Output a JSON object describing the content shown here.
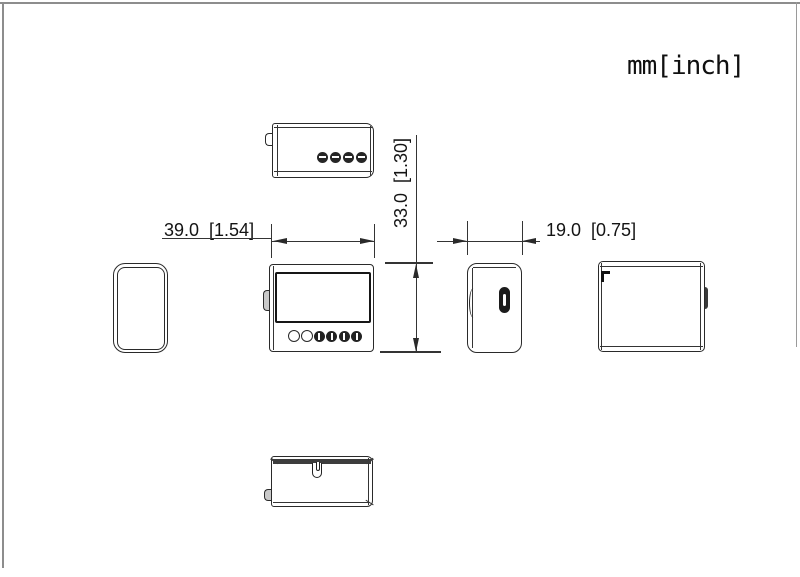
{
  "drawing": {
    "units_label": "mm[inch]",
    "dimensions": {
      "width_mm_inch": "39.0  [1.54]",
      "height_mm_inch": "33.0  [1.30]",
      "depth_mm_inch": "19.0  [0.75]"
    },
    "line_color": "#2a2a2a",
    "accent_dark": "#1d1d1d"
  }
}
